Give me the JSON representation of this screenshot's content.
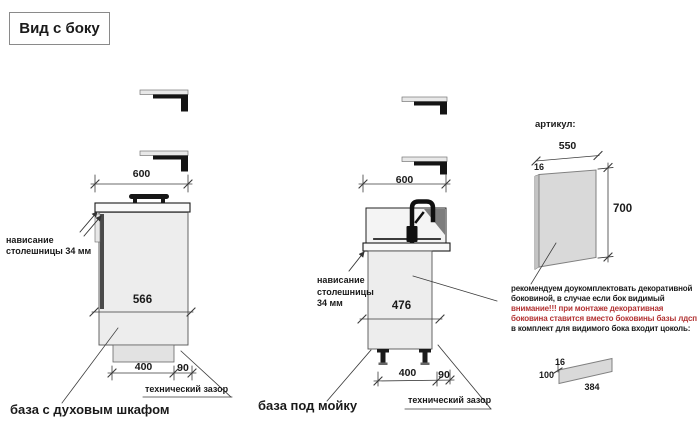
{
  "title": "Вид с боку",
  "colors": {
    "warning_red": "#b23333",
    "line": "#3a3a3a",
    "cabinet_fill": "#ededed",
    "dark_parts": "#141414"
  },
  "icons": [
    "wall-bracket-icon",
    "oven-handle-icon",
    "faucet-icon",
    "adjustable-foot-icon"
  ],
  "oven_base": {
    "caption": "база с духовым шкафом",
    "overhang_line1": "нависание",
    "overhang_line2": "столешницы 34 мм",
    "dim_top_width": "600",
    "dim_depth": "566",
    "dim_plinth": "400",
    "dim_gap": "90",
    "gap_label": "технический зазор"
  },
  "sink_base": {
    "caption": "база под мойку",
    "overhang_line1": "нависание",
    "overhang_line2": "столешницы",
    "overhang_line3": "34 мм",
    "dim_top_width": "600",
    "dim_depth": "476",
    "dim_plinth": "400",
    "dim_gap": "90",
    "gap_label": "технический зазор"
  },
  "side_panel": {
    "label": "артикул:",
    "dim_width": "550",
    "dim_thickness": "16",
    "dim_height": "700"
  },
  "notes": {
    "lines": [
      {
        "text": "рекомендуем доукомплектовать декоративной",
        "color": "black"
      },
      {
        "text": "боковиной, в случае если бок видимый",
        "color": "black"
      },
      {
        "text": "внимание!!! при монтаже декоративная",
        "color": "red"
      },
      {
        "text": "боковина ставится вместо боковины базы лдсп",
        "color": "red"
      },
      {
        "text": "в комплект для видимого бока входит цоколь:",
        "color": "black"
      }
    ]
  },
  "plinth_panel": {
    "dim_thickness": "16",
    "dim_height": "100",
    "dim_width": "384"
  }
}
